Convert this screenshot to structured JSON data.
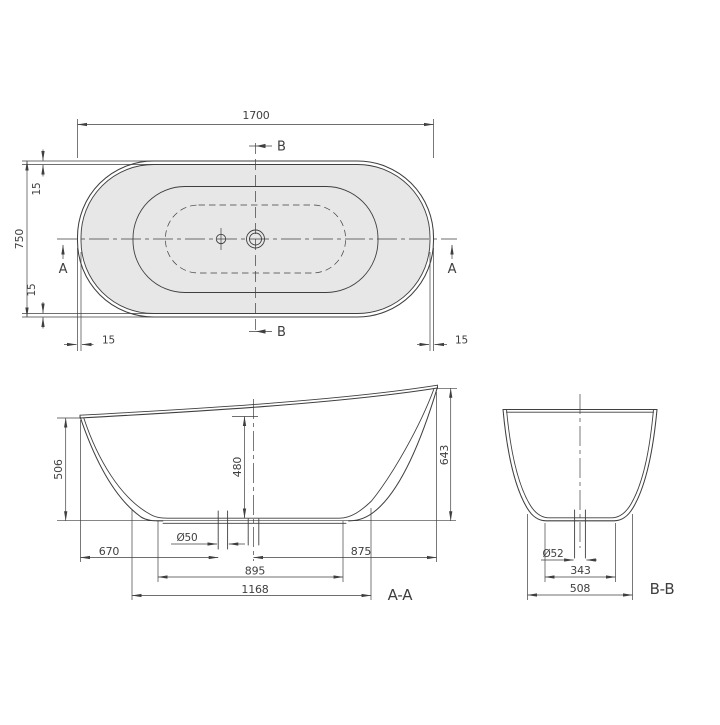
{
  "title": "Bathtub dimension drawing",
  "colors": {
    "line": "#3f3f3f",
    "fill": "#e7e7e7",
    "background": "#ffffff"
  },
  "top_view": {
    "dim_length": "1700",
    "dim_width": "750",
    "dim_rim_top": "15",
    "dim_rim_bottom": "15",
    "dim_rim_left": "15",
    "dim_rim_right": "15",
    "marker_a_left": "A",
    "marker_a_right": "A",
    "marker_b_top": "B",
    "marker_b_bottom": "B"
  },
  "section_aa": {
    "label": "A-A",
    "dim_height_front": "506",
    "dim_inner_depth": "480",
    "dim_height_back": "643",
    "dim_drain_diameter": "Ø50",
    "dim_front_to_drain": "670",
    "dim_center_to_back": "875",
    "dim_floor_length": "895",
    "dim_base_length": "1168"
  },
  "section_bb": {
    "label": "B-B",
    "dim_drain_diameter": "Ø52",
    "dim_floor_width": "343",
    "dim_base_width": "508"
  }
}
